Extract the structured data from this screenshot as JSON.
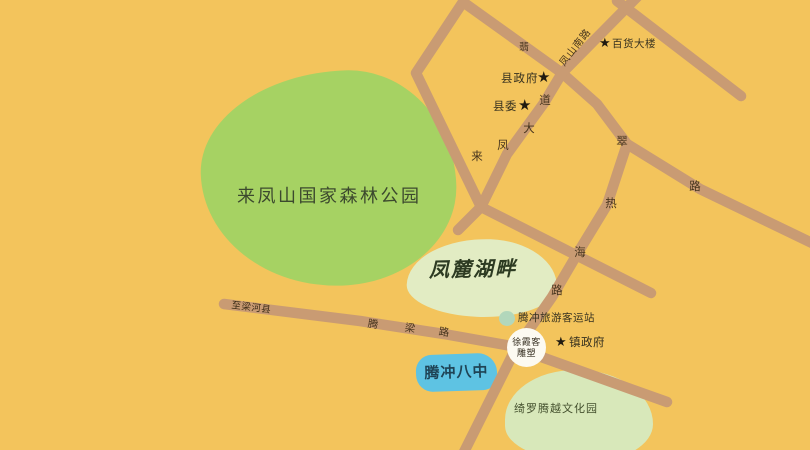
{
  "colors": {
    "bg": "#f3c45c",
    "road": "#c99b73",
    "park": "#a6d263",
    "pale": "#e2ecc3",
    "pale2": "#d8e8ba",
    "blue": "#5ec3e3",
    "dot": "#b2d7bb",
    "circle": "#fcfaf1",
    "ink": "#35301f",
    "roadink": "#46341d"
  },
  "areas": {
    "park": {
      "label": "来凤山国家森林公园"
    },
    "lake": {
      "label": "凤麓湖畔"
    },
    "school": {
      "label": "腾冲八中"
    },
    "culture": {
      "label": "绮罗腾越文化园"
    }
  },
  "roads": {
    "fengshannan": {
      "label": "凤山南路"
    },
    "laifeng": {
      "label": "来凤大道",
      "chars": [
        "来",
        "凤",
        "大",
        "道"
      ]
    },
    "rehai": {
      "label": "热海路",
      "chars": [
        "热",
        "海",
        "路"
      ]
    },
    "feicui": {
      "label": "翡翠路",
      "chars": [
        "翡",
        "翠",
        "路"
      ]
    },
    "tengliang": {
      "label": "腾梁路",
      "chars": [
        "腾",
        "梁",
        "路"
      ]
    },
    "to_lianghe": {
      "label": "至梁河县"
    }
  },
  "pois": {
    "department_store": {
      "label": "百货大楼",
      "marker": "star"
    },
    "county_government": {
      "label": "县政府",
      "marker": "star"
    },
    "county_committee": {
      "label": "县委",
      "marker": "star"
    },
    "town_government": {
      "label": "镇政府",
      "marker": "star"
    },
    "bus_station": {
      "label": "腾冲旅游客运站",
      "marker": "dot"
    },
    "xuxiake_statue": {
      "label": "徐霞客雕塑",
      "line1": "徐霞客",
      "line2": "雕塑",
      "marker": "circle"
    }
  },
  "glyphs": {
    "star": "★"
  }
}
